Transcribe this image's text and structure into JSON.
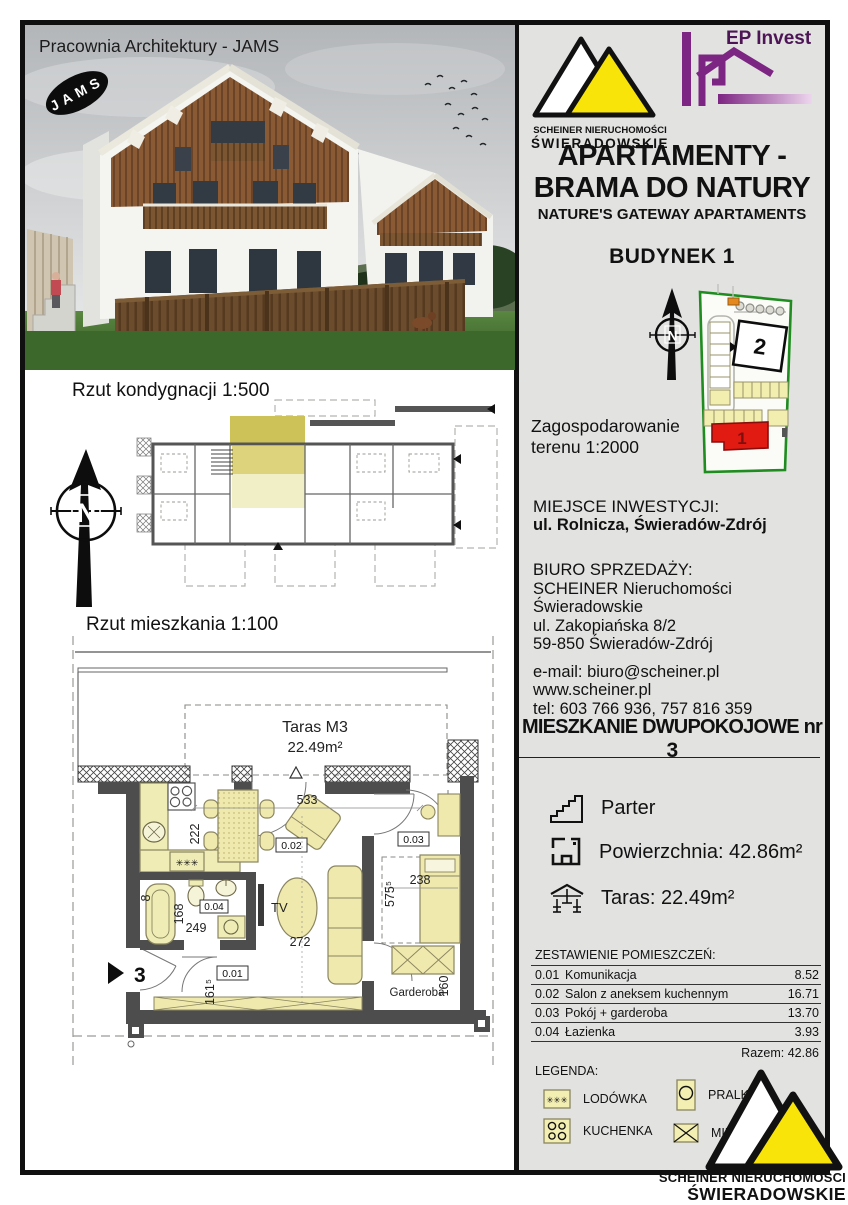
{
  "page": {
    "accent_yellow": "#f8e408",
    "accent_red": "#e11a12",
    "accent_green": "#1f8c1f",
    "accent_purple": "#7d2583",
    "panel_gray": "#e2e2e1"
  },
  "photo": {
    "credit": "Pracownia Architektury - JAMS",
    "jams_logo": "JAMS"
  },
  "brand": {
    "scheiner_line1": "SCHEINER NIERUCHOMOŚCI",
    "scheiner_line2": "ŚWIERADOWSKIE",
    "ep_invest": "EP Invest"
  },
  "header": {
    "title_line1": "APARTAMENTY -",
    "title_line2": "BRAMA DO NATURY",
    "subtitle": "NATURE'S GATEWAY APARTAMENTS",
    "building": "BUDYNEK 1"
  },
  "site_plan": {
    "caption_line1": "Zagospodarowanie",
    "caption_line2": "terenu 1:2000",
    "building_1": "1",
    "building_2": "2"
  },
  "compass": {
    "letter": "N"
  },
  "location": {
    "heading": "MIEJSCE INWESTYCJI:",
    "address": "ul. Rolnicza, Świeradów-Zdrój"
  },
  "sales_office": {
    "heading": "BIURO SPRZEDAŻY:",
    "company": "SCHEINER Nieruchomości Świeradowskie",
    "street": "ul. Zakopiańska 8/2",
    "city": "59-850 Świeradów-Zdrój",
    "email": "e-mail: biuro@scheiner.pl",
    "website": "www.scheiner.pl",
    "phone": "tel: 603 766 936, 757 816 359"
  },
  "apartment": {
    "title": "MIESZKANIE DWUPOKOJOWE nr ",
    "number": "3",
    "floor": "Parter",
    "area": "Powierzchnia: 42.86m²",
    "terrace": "Taras: 22.49m²"
  },
  "room_table": {
    "heading": "ZESTAWIENIE POMIESZCZEŃ:",
    "rows": [
      {
        "id": "0.01",
        "name": "Komunikacja",
        "area": "8.52"
      },
      {
        "id": "0.02",
        "name": "Salon z aneksem kuchennym",
        "area": "16.71"
      },
      {
        "id": "0.03",
        "name": "Pokój + garderoba",
        "area": "13.70"
      },
      {
        "id": "0.04",
        "name": "Łazienka",
        "area": "3.93"
      }
    ],
    "total": "Razem: 42.86"
  },
  "legend": {
    "heading": "LEGENDA:",
    "items": [
      {
        "label": "LODÓWKA"
      },
      {
        "label": "KUCHENKA"
      },
      {
        "label": "PRALKA"
      },
      {
        "label": "MIE"
      }
    ]
  },
  "icons": {
    "fridge_glyph": "✳✳✳"
  },
  "plan500": {
    "title": "Rzut kondygnacji 1:500"
  },
  "plan100": {
    "title": "Rzut mieszkania 1:100",
    "terrace_name": "Taras M3",
    "terrace_area": "22.49m²",
    "room_01": "0.01",
    "room_02": "0.02",
    "room_03": "0.03",
    "room_04": "0.04",
    "tv": "TV",
    "garderoba": "Garderoba",
    "entrance_no": "3",
    "dims": {
      "d533": "533",
      "d222": "222",
      "d168": "168",
      "d249": "249",
      "d161": "161⁵",
      "d272": "272",
      "d238": "238",
      "d575": "575⁵",
      "d160": "160",
      "d8": "8"
    }
  },
  "footer_logo": {
    "line1": "SCHEINER NIERUCHOMOŚCI",
    "line2": "ŚWIERADOWSKIE"
  }
}
